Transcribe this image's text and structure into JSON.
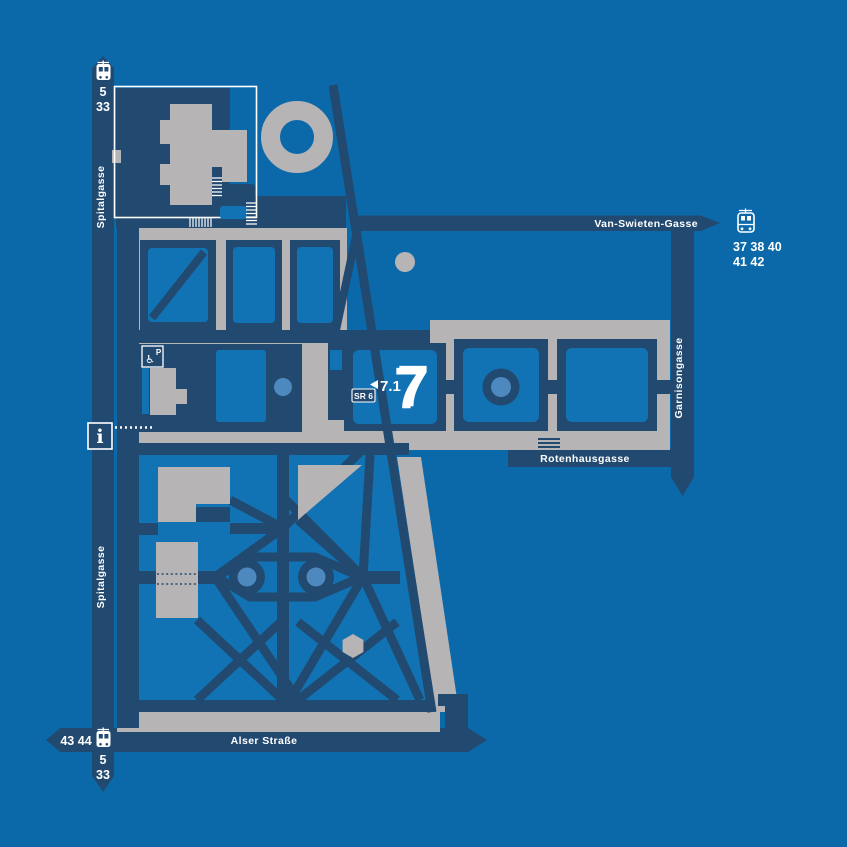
{
  "streets": {
    "spitalgasse": "Spitalgasse",
    "alser_strasse": "Alser Straße",
    "van_swieten_gasse": "Van-Swieten-Gasse",
    "garnisongasse": "Garnisongasse",
    "rotenhausgasse": "Rotenhausgasse"
  },
  "transit": {
    "spitalgasse_top_line1": "5",
    "spitalgasse_top_line2": "33",
    "spitalgasse_bottom_line1": "5",
    "spitalgasse_bottom_line2": "33",
    "alser_left_lines": "43 44",
    "van_swieten_row1": "37 38 40",
    "van_swieten_row2": "41 42"
  },
  "markers": {
    "courtyard_number": "7",
    "entrance_label": "7.1",
    "room_badge": "SR 6",
    "info_letter": "i",
    "parking_letter": "P",
    "wheelchair_glyph": "♿"
  },
  "colors": {
    "background": "#0b69aa",
    "street_navy": "#224a70",
    "building_gray": "#b7b4b6",
    "courtyard_blue": "#1173b4",
    "accent_light_blue": "#4d88be",
    "text": "#ffffff"
  }
}
